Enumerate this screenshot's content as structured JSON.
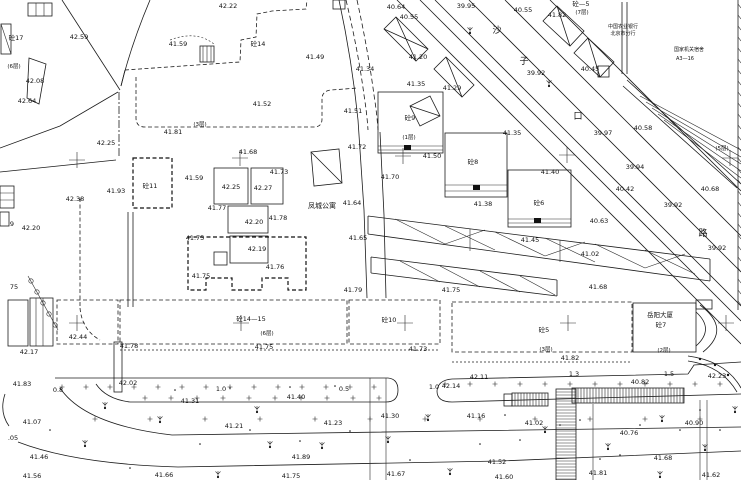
{
  "map": {
    "type": "survey-site-plan",
    "background": "#ffffff",
    "line_color": "#1c1c1c",
    "text_color": "#111111",
    "street_name_chars": [
      {
        "ch": "沙",
        "x": 497,
        "y": 33
      },
      {
        "ch": "子",
        "x": 524,
        "y": 64
      },
      {
        "ch": "口",
        "x": 578,
        "y": 119
      },
      {
        "ch": "路",
        "x": 703,
        "y": 236
      }
    ],
    "places": [
      {
        "name": "凤城公寓",
        "x": 322,
        "y": 208,
        "cls": "place"
      },
      {
        "name": "中国农业银行",
        "x": 623,
        "y": 28,
        "cls": "tiny"
      },
      {
        "name": "北京市分行",
        "x": 623,
        "y": 35,
        "cls": "tiny"
      },
      {
        "name": "国家机关宿舍",
        "x": 689,
        "y": 51,
        "cls": "tiny"
      },
      {
        "name": "A3—16",
        "x": 685,
        "y": 60,
        "cls": "tiny"
      },
      {
        "name": "岳阳大厦",
        "x": 660,
        "y": 317,
        "cls": "bldg"
      },
      {
        "name": "砼7",
        "x": 661,
        "y": 327,
        "cls": "bldg"
      }
    ],
    "buildings": [
      {
        "label": "砼17",
        "x": 16,
        "y": 40
      },
      {
        "label": "砼14",
        "x": 258,
        "y": 46
      },
      {
        "label": "砼11",
        "x": 150,
        "y": 188
      },
      {
        "label": "砼9",
        "x": 410,
        "y": 120
      },
      {
        "label": "砼8",
        "x": 473,
        "y": 164
      },
      {
        "label": "砼6",
        "x": 539,
        "y": 205
      },
      {
        "label": "砼14—15",
        "x": 251,
        "y": 321
      },
      {
        "label": "砼10",
        "x": 389,
        "y": 322
      },
      {
        "label": "砼5",
        "x": 544,
        "y": 332
      },
      {
        "label": "砼—5",
        "x": 581,
        "y": 6
      }
    ],
    "floor_notes": [
      {
        "text": "(7层)",
        "x": 582,
        "y": 14
      },
      {
        "text": "(6层)",
        "x": 14,
        "y": 68
      },
      {
        "text": "(3层)",
        "x": 200,
        "y": 126
      },
      {
        "text": "(1层)",
        "x": 409,
        "y": 139
      },
      {
        "text": "(6层)",
        "x": 267,
        "y": 335
      },
      {
        "text": "(3层)",
        "x": 546,
        "y": 351
      },
      {
        "text": "(2层)",
        "x": 664,
        "y": 352
      },
      {
        "text": "(5层)",
        "x": 722,
        "y": 150
      }
    ],
    "elevations": [
      {
        "v": "42.22",
        "x": 228,
        "y": 8
      },
      {
        "v": "42.59",
        "x": 79,
        "y": 39
      },
      {
        "v": "41.59",
        "x": 178,
        "y": 46
      },
      {
        "v": "40.64",
        "x": 396,
        "y": 9
      },
      {
        "v": "40.55",
        "x": 409,
        "y": 19
      },
      {
        "v": "39.95",
        "x": 466,
        "y": 8
      },
      {
        "v": "40.55",
        "x": 523,
        "y": 12
      },
      {
        "v": "41.82",
        "x": 557,
        "y": 17
      },
      {
        "v": "42.08",
        "x": 35,
        "y": 83
      },
      {
        "v": "42.64",
        "x": 27,
        "y": 103
      },
      {
        "v": "41.49",
        "x": 315,
        "y": 59
      },
      {
        "v": "41.52",
        "x": 262,
        "y": 106
      },
      {
        "v": "41.81",
        "x": 173,
        "y": 134
      },
      {
        "v": "42.25",
        "x": 106,
        "y": 145
      },
      {
        "v": "41.20",
        "x": 418,
        "y": 59
      },
      {
        "v": "41.34",
        "x": 365,
        "y": 71
      },
      {
        "v": "41.35",
        "x": 416,
        "y": 86
      },
      {
        "v": "41.29",
        "x": 452,
        "y": 90
      },
      {
        "v": "41.51",
        "x": 353,
        "y": 113
      },
      {
        "v": "41.72",
        "x": 357,
        "y": 149
      },
      {
        "v": "41.70",
        "x": 390,
        "y": 179
      },
      {
        "v": "41.50",
        "x": 432,
        "y": 158
      },
      {
        "v": "39.92",
        "x": 536,
        "y": 75
      },
      {
        "v": "40.45",
        "x": 590,
        "y": 71
      },
      {
        "v": "40.58",
        "x": 643,
        "y": 130
      },
      {
        "v": "39.97",
        "x": 603,
        "y": 135
      },
      {
        "v": "41.35",
        "x": 512,
        "y": 135
      },
      {
        "v": "41.40",
        "x": 550,
        "y": 174
      },
      {
        "v": "41.38",
        "x": 483,
        "y": 206
      },
      {
        "v": "40.42",
        "x": 625,
        "y": 191
      },
      {
        "v": "40.68",
        "x": 710,
        "y": 191
      },
      {
        "v": "39.92",
        "x": 673,
        "y": 207
      },
      {
        "v": "39.94",
        "x": 635,
        "y": 169
      },
      {
        "v": "40.63",
        "x": 599,
        "y": 223
      },
      {
        "v": "41.45",
        "x": 530,
        "y": 242
      },
      {
        "v": "39.92",
        "x": 717,
        "y": 250
      },
      {
        "v": "41.93",
        "x": 116,
        "y": 193
      },
      {
        "v": "41.59",
        "x": 194,
        "y": 180
      },
      {
        "v": "42.25",
        "x": 231,
        "y": 189
      },
      {
        "v": "42.27",
        "x": 263,
        "y": 190
      },
      {
        "v": "41.77",
        "x": 217,
        "y": 210
      },
      {
        "v": "41.78",
        "x": 278,
        "y": 220
      },
      {
        "v": "42.20",
        "x": 254,
        "y": 224
      },
      {
        "v": "41.75",
        "x": 195,
        "y": 240
      },
      {
        "v": "42.19",
        "x": 257,
        "y": 251
      },
      {
        "v": "41.76",
        "x": 275,
        "y": 269
      },
      {
        "v": "41.75",
        "x": 201,
        "y": 278
      },
      {
        "v": "42.38",
        "x": 75,
        "y": 201
      },
      {
        "v": "42.20",
        "x": 31,
        "y": 230
      },
      {
        "v": "41.64",
        "x": 352,
        "y": 205
      },
      {
        "v": "41.65",
        "x": 358,
        "y": 240
      },
      {
        "v": "41.73",
        "x": 279,
        "y": 174
      },
      {
        "v": "41.68",
        "x": 248,
        "y": 154
      },
      {
        "v": "41.79",
        "x": 353,
        "y": 292
      },
      {
        "v": "41.75",
        "x": 451,
        "y": 292
      },
      {
        "v": "41.02",
        "x": 590,
        "y": 256
      },
      {
        "v": "41.68",
        "x": 598,
        "y": 289
      },
      {
        "v": "42.44",
        "x": 78,
        "y": 339
      },
      {
        "v": "42.17",
        "x": 29,
        "y": 354
      },
      {
        "v": "41.78",
        "x": 129,
        "y": 348
      },
      {
        "v": "41.75",
        "x": 264,
        "y": 349
      },
      {
        "v": "41.73",
        "x": 418,
        "y": 351
      },
      {
        "v": "41.82",
        "x": 570,
        "y": 360
      },
      {
        "v": "41.83",
        "x": 22,
        "y": 386
      },
      {
        "v": "42.02",
        "x": 128,
        "y": 385
      },
      {
        "v": "41.31",
        "x": 190,
        "y": 403
      },
      {
        "v": "41.40",
        "x": 296,
        "y": 399
      },
      {
        "v": "42.14",
        "x": 451,
        "y": 388
      },
      {
        "v": "42.11",
        "x": 479,
        "y": 379
      },
      {
        "v": "41.30",
        "x": 390,
        "y": 418
      },
      {
        "v": "41.16",
        "x": 476,
        "y": 418
      },
      {
        "v": "42.23",
        "x": 717,
        "y": 378
      },
      {
        "v": "40.82",
        "x": 640,
        "y": 384
      },
      {
        "v": "41.07",
        "x": 32,
        "y": 424
      },
      {
        "v": "41.21",
        "x": 234,
        "y": 428
      },
      {
        "v": "41.23",
        "x": 333,
        "y": 425
      },
      {
        "v": "41.02",
        "x": 534,
        "y": 425
      },
      {
        "v": "40.90",
        "x": 694,
        "y": 425
      },
      {
        "v": "40.76",
        "x": 629,
        "y": 435
      },
      {
        "v": "41.46",
        "x": 39,
        "y": 459
      },
      {
        "v": "41.89",
        "x": 301,
        "y": 459
      },
      {
        "v": "41.68",
        "x": 663,
        "y": 460
      },
      {
        "v": "41.52",
        "x": 497,
        "y": 464
      },
      {
        "v": "41.56",
        "x": 32,
        "y": 478
      },
      {
        "v": "41.66",
        "x": 164,
        "y": 477
      },
      {
        "v": "41.75",
        "x": 291,
        "y": 478
      },
      {
        "v": "41.67",
        "x": 396,
        "y": 476
      },
      {
        "v": "41.60",
        "x": 504,
        "y": 479
      },
      {
        "v": "41.81",
        "x": 598,
        "y": 475
      },
      {
        "v": "41.62",
        "x": 711,
        "y": 477
      }
    ],
    "dimensions": [
      {
        "v": "0.8",
        "x": 58,
        "y": 392
      },
      {
        "v": "1.0",
        "x": 221,
        "y": 391
      },
      {
        "v": "0.5",
        "x": 344,
        "y": 391
      },
      {
        "v": "1.0",
        "x": 434,
        "y": 389
      },
      {
        "v": "1.3",
        "x": 574,
        "y": 376
      },
      {
        "v": "1.5",
        "x": 669,
        "y": 376
      }
    ],
    "misc_labels": [
      {
        "v": "9",
        "x": 12,
        "y": 226
      },
      {
        "v": "75",
        "x": 14,
        "y": 289
      },
      {
        "v": ".05",
        "x": 13,
        "y": 440
      }
    ],
    "symbols": {
      "grid_crosses": [
        [
          77,
          160
        ],
        [
          240,
          158
        ],
        [
          403,
          156
        ],
        [
          567,
          155
        ],
        [
          730,
          158
        ],
        [
          77,
          323
        ],
        [
          241,
          323
        ],
        [
          405,
          323
        ],
        [
          568,
          323
        ],
        [
          726,
          323
        ]
      ],
      "trees": [
        [
          470,
          33
        ],
        [
          549,
          86
        ],
        [
          105,
          408
        ],
        [
          160,
          422
        ],
        [
          257,
          412
        ],
        [
          322,
          448
        ],
        [
          388,
          442
        ],
        [
          428,
          420
        ],
        [
          545,
          432
        ],
        [
          608,
          449
        ],
        [
          662,
          421
        ],
        [
          705,
          450
        ],
        [
          735,
          412
        ],
        [
          218,
          477
        ],
        [
          85,
          446
        ],
        [
          270,
          447
        ],
        [
          450,
          474
        ],
        [
          660,
          477
        ]
      ],
      "dots": [
        [
          200,
          444
        ],
        [
          250,
          430
        ],
        [
          300,
          441
        ],
        [
          350,
          431
        ],
        [
          480,
          444
        ],
        [
          520,
          440
        ],
        [
          600,
          459
        ],
        [
          640,
          425
        ],
        [
          680,
          430
        ],
        [
          130,
          468
        ],
        [
          410,
          460
        ],
        [
          560,
          425
        ],
        [
          175,
          390
        ],
        [
          230,
          388
        ],
        [
          290,
          387
        ],
        [
          335,
          386
        ],
        [
          700,
          410
        ],
        [
          720,
          430
        ],
        [
          50,
          430
        ],
        [
          620,
          455
        ],
        [
          580,
          420
        ],
        [
          505,
          415
        ]
      ],
      "plus_rows": [
        {
          "y": 387,
          "x0": 62,
          "x1": 388,
          "step": 24
        },
        {
          "y": 398,
          "x0": 145,
          "x1": 385,
          "step": 26
        },
        {
          "y": 384,
          "x0": 445,
          "x1": 738,
          "step": 25
        },
        {
          "y": 419,
          "x0": 95,
          "x1": 738,
          "step": 55
        }
      ],
      "hatch_bands": [
        {
          "x": 572,
          "y": 388,
          "w": 112,
          "h": 15,
          "dir": "v",
          "step": 3
        },
        {
          "x": 512,
          "y": 393,
          "w": 36,
          "h": 13,
          "dir": "v",
          "step": 3
        },
        {
          "x": 556,
          "y": 389,
          "w": 20,
          "h": 91,
          "dir": "h",
          "step": 3
        }
      ],
      "edge_ticks": {
        "x": 738,
        "y0": 4,
        "y1": 308,
        "step": 11
      },
      "hedge_circles": [
        [
          31,
          281
        ],
        [
          37,
          292
        ],
        [
          43,
          303
        ],
        [
          49,
          314
        ],
        [
          55,
          325
        ]
      ],
      "fence_posts": [
        [
          700,
          359
        ],
        [
          715,
          365
        ],
        [
          728,
          375
        ]
      ]
    }
  }
}
